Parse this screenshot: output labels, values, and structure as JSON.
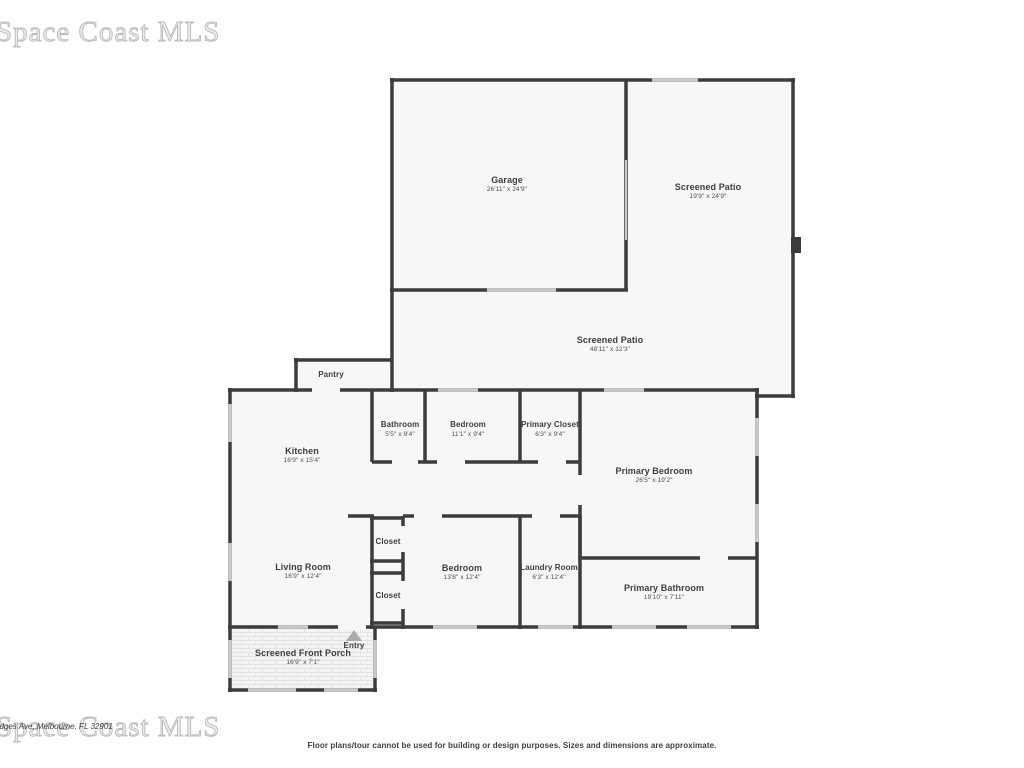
{
  "watermark": {
    "text": "Space Coast MLS"
  },
  "address_fragment": "odges Ave, Melbourne, FL 32901",
  "disclaimer": "Floor plans/tour cannot be used for building or design purposes. Sizes and dimensions are approximate.",
  "colors": {
    "wall": "#3c3c3c",
    "room_fill": "#f7f7f7",
    "window": "#c9c9c9",
    "label_text": "#3d3d3d",
    "watermark": "#b9b9b9",
    "entry_arrow": "#aaaaaa"
  },
  "rooms": {
    "garage": {
      "name": "Garage",
      "dims": "26'11\" x 24'9\""
    },
    "screened_patio_upper": {
      "name": "Screened Patio",
      "dims": "19'9\" x 24'9\""
    },
    "screened_patio_lower": {
      "name": "Screened Patio",
      "dims": "48'11\" x 12'3\""
    },
    "pantry": {
      "name": "Pantry"
    },
    "bathroom": {
      "name": "Bathroom",
      "dims": "5'5\" x 9'4\""
    },
    "bedroom_top": {
      "name": "Bedroom",
      "dims": "11'1\" x 9'4\""
    },
    "primary_closet": {
      "name": "Primary Closet",
      "dims": "6'3\" x 9'4\""
    },
    "kitchen": {
      "name": "Kitchen",
      "dims": "16'9\" x 15'4\""
    },
    "primary_bedroom": {
      "name": "Primary Bedroom",
      "dims": "26'5\" x 19'2\""
    },
    "living_room": {
      "name": "Living Room",
      "dims": "16'9\" x 12'4\""
    },
    "closet_upper": {
      "name": "Closet"
    },
    "closet_lower": {
      "name": "Closet"
    },
    "bedroom_bottom": {
      "name": "Bedroom",
      "dims": "13'8\" x 12'4\""
    },
    "laundry": {
      "name": "Laundry Room",
      "dims": "6'3\" x 12'4\""
    },
    "primary_bathroom": {
      "name": "Primary Bathroom",
      "dims": "19'10\" x 7'11\""
    },
    "front_porch": {
      "name": "Screened Front Porch",
      "dims": "16'9\" x 7'1\""
    },
    "entry": {
      "name": "Entry"
    }
  }
}
